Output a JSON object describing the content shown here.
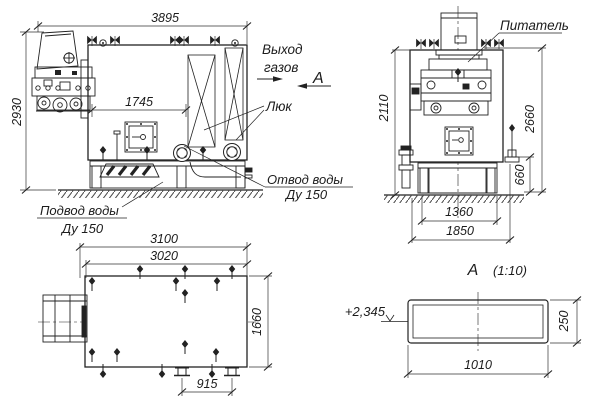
{
  "drawing": {
    "labels": {
      "gas1": "Выход",
      "gas2": "газов",
      "section_mark": "A",
      "hatch": "Люк",
      "outlet1": "Отвод воды",
      "outlet2": "Ду 150",
      "inlet1": "Подвод воды",
      "inlet2": "Ду 150",
      "feeder": "Питатель",
      "sect_title": "A",
      "sect_scale": "(1:10)",
      "level": "+2,345"
    },
    "dims": {
      "side_width": "3895",
      "side_height": "2930",
      "side_inner": "1745",
      "front_height": "2110",
      "front_total": "2660",
      "front_base": "660",
      "base_inner": "1360",
      "base_outer": "1850",
      "top_outer": "3100",
      "top_inner": "3020",
      "top_depth": "1660",
      "pipes": "915",
      "sect_len": "1010",
      "sect_h": "250"
    },
    "colors": {
      "ink": "#1c1c1c",
      "paper": "#ffffff"
    }
  }
}
